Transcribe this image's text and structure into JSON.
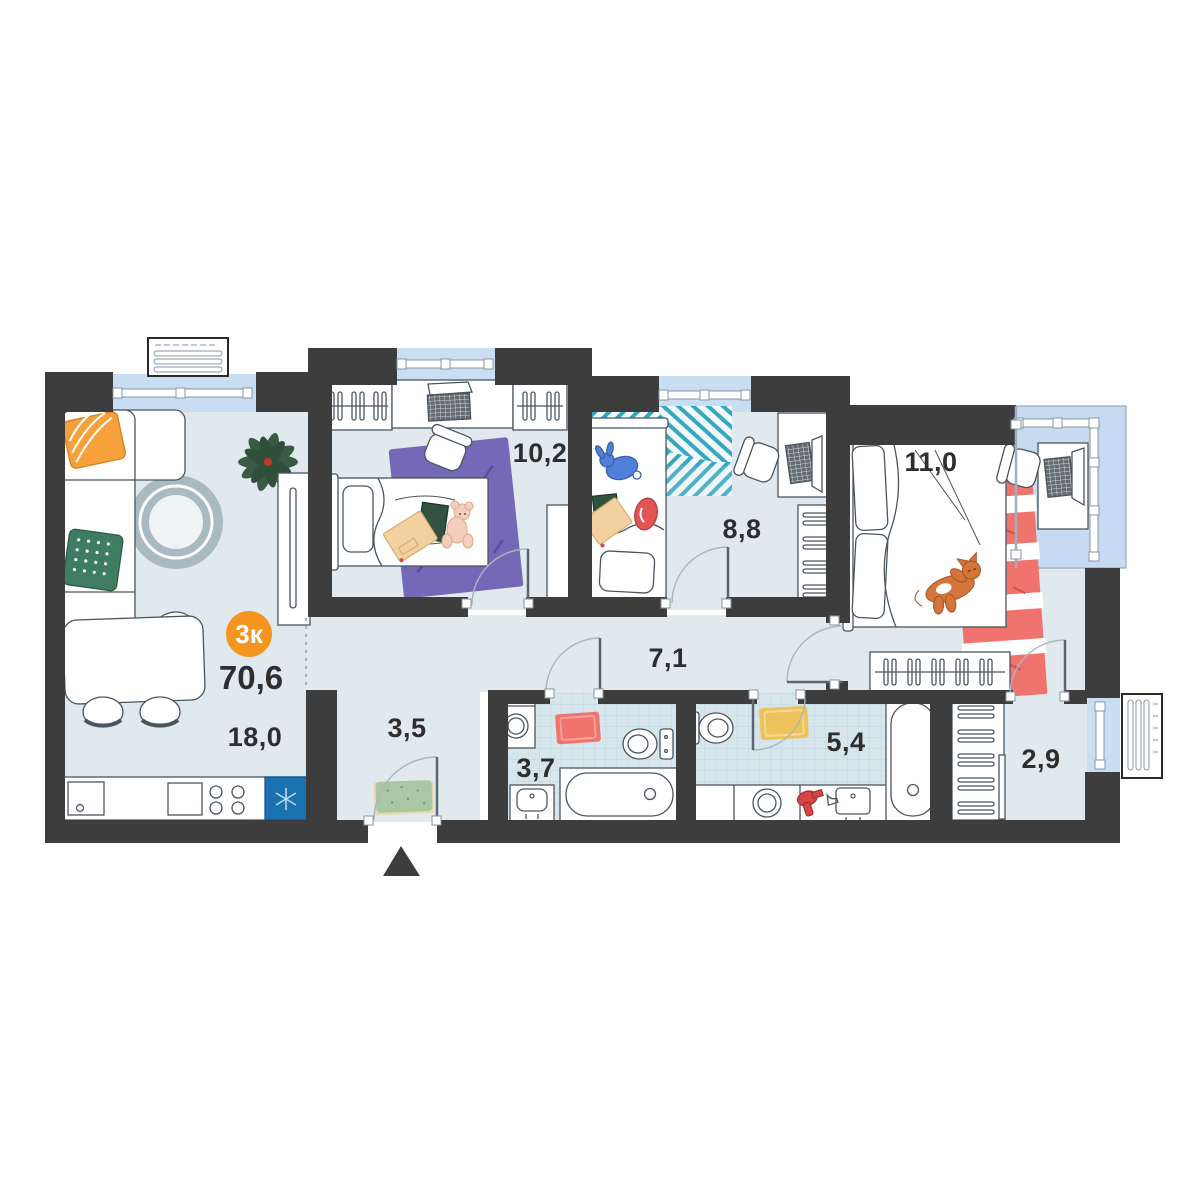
{
  "plan": {
    "title": "apartment-floor-plan",
    "type_badge": {
      "label": "3к",
      "bg_color": "#f5941f",
      "text_color": "#ffffff"
    },
    "total_area": "70,6",
    "rooms": [
      {
        "name": "kitchen-living-room",
        "area": "18,0"
      },
      {
        "name": "hallway",
        "area": "3,5"
      },
      {
        "name": "bedroom-1",
        "area": "10,2"
      },
      {
        "name": "bedroom-2",
        "area": "8,8"
      },
      {
        "name": "corridor",
        "area": "7,1"
      },
      {
        "name": "bedroom-3",
        "area": "11,0"
      },
      {
        "name": "bathroom-1",
        "area": "3,7"
      },
      {
        "name": "bathroom-2",
        "area": "5,4"
      },
      {
        "name": "walk-in-closet",
        "area": "2,9"
      }
    ],
    "icons": {
      "entrance_marker": "entrance-triangle",
      "fridge_symbol": "snowflake-asterisk"
    },
    "colors": {
      "wall": "#3d3d3d",
      "floor": "#dfe9ee",
      "tile_floor": "#d7e5ec",
      "window_glass": "#c9ddf3",
      "accent_orange": "#f5941f",
      "fridge_blue": "#1a72b0",
      "rug_purple": "#7568b6",
      "rug_red": "#f0736e",
      "rug_yellow": "#eec25a",
      "rug_green": "#a9c7a4",
      "rug_teal": "#35a7c2"
    }
  }
}
